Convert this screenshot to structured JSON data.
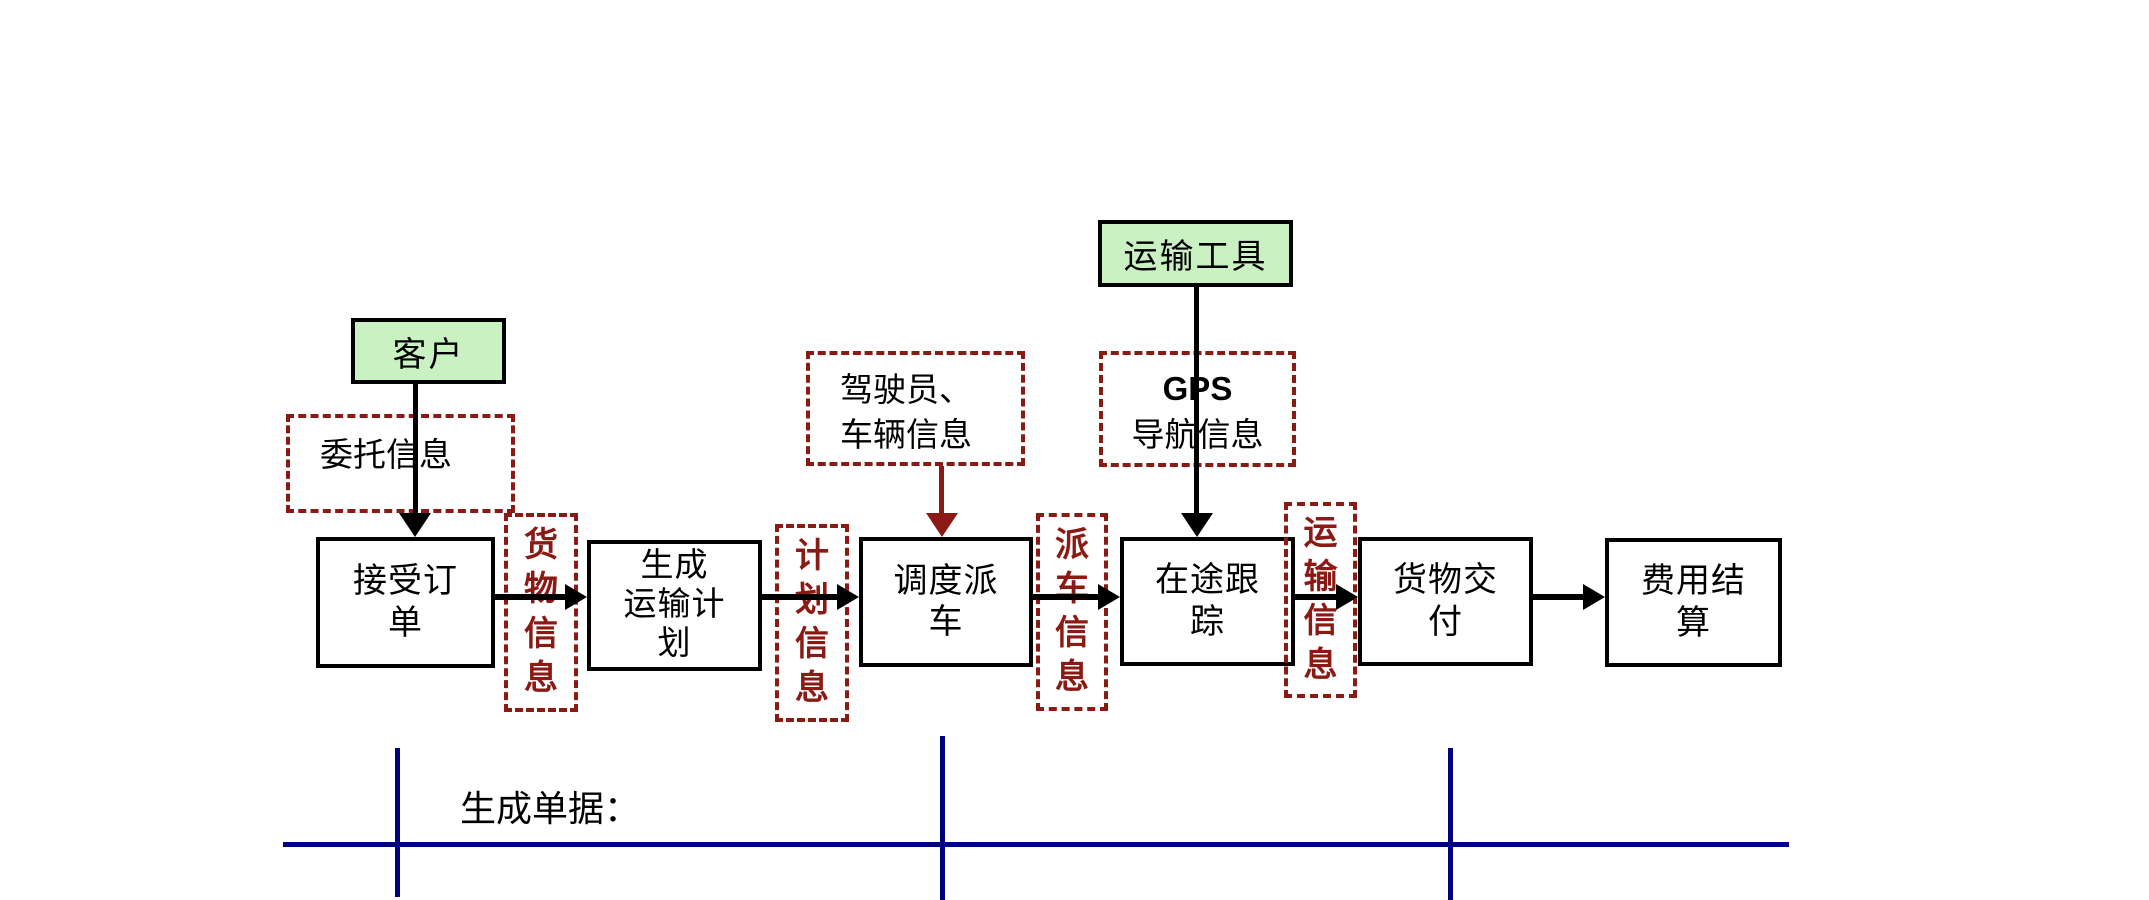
{
  "colors": {
    "green_fill": "#c9f1c2",
    "dark_red": "#8b1a14",
    "navy": "#000082",
    "black": "#000000",
    "bg": "#ffffff"
  },
  "entities": {
    "customer": {
      "label": "客户"
    },
    "vehicle": {
      "label": "运输工具"
    }
  },
  "inputs": {
    "entrust": {
      "label": "委托信息"
    },
    "driver": {
      "line1": "驾驶员、",
      "line2": "车辆信息"
    },
    "gps": {
      "line1": "GPS",
      "line2": "导航信息"
    }
  },
  "steps": [
    {
      "lines": [
        "接受订",
        "单"
      ]
    },
    {
      "lines": [
        "生成",
        "运输计",
        "划"
      ]
    },
    {
      "lines": [
        "调度派",
        "车"
      ]
    },
    {
      "lines": [
        "在途跟",
        "踪"
      ]
    },
    {
      "lines": [
        "货物交",
        "付"
      ]
    },
    {
      "lines": [
        "费用结",
        "算"
      ]
    }
  ],
  "flow_labels": [
    {
      "label": "货物信息"
    },
    {
      "label": "计划信息"
    },
    {
      "label": "派车信息"
    },
    {
      "label": "运输信息"
    }
  ],
  "footer": {
    "label": "生成单据："
  }
}
